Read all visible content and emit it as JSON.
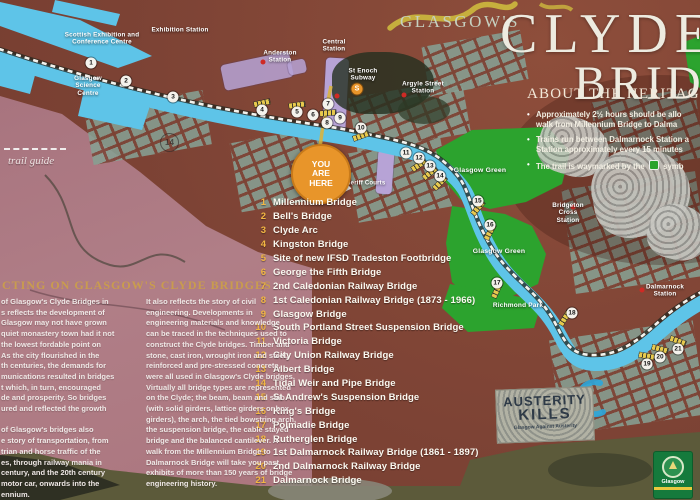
{
  "title": {
    "kicker": "GLASGOW'S",
    "line1": "CLYDE",
    "line2": "BRIDGES"
  },
  "heritage": {
    "heading": "ABOUT THE HERITAGE",
    "bullets": [
      {
        "lines": [
          "Approximately 2½ hours should be allo",
          "walk from Millennium Bridge to Dalma"
        ]
      },
      {
        "lines": [
          "Trains run between Dalmarnock Station a",
          "Station approximately every 15 minutes"
        ]
      },
      {
        "pre": "The trail is waymarked by the",
        "post": "symb"
      }
    ]
  },
  "bridge_list": [
    {
      "num": "1",
      "name": "Millennium Bridge"
    },
    {
      "num": "2",
      "name": "Bell's Bridge"
    },
    {
      "num": "3",
      "name": "Clyde Arc"
    },
    {
      "num": "4",
      "name": "Kingston Bridge"
    },
    {
      "num": "5",
      "name": "Site of new IFSD Tradeston Footbridge"
    },
    {
      "num": "6",
      "name": "George the Fifth Bridge"
    },
    {
      "num": "7",
      "name": "2nd Caledonian Railway Bridge"
    },
    {
      "num": "8",
      "name": "1st Caledonian Railway Bridge (1873 - 1966)"
    },
    {
      "num": "9",
      "name": "Glasgow Bridge"
    },
    {
      "num": "10",
      "name": "South Portland Street Suspension Bridge"
    },
    {
      "num": "11",
      "name": "Victoria Bridge"
    },
    {
      "num": "12",
      "name": "City Union Railway Bridge"
    },
    {
      "num": "13",
      "name": "Albert Bridge"
    },
    {
      "num": "14",
      "name": "Tidal Weir and Pipe Bridge"
    },
    {
      "num": "15",
      "name": "St Andrew's Suspension Bridge"
    },
    {
      "num": "16",
      "name": "King's Bridge"
    },
    {
      "num": "17",
      "name": "Polmadie Bridge"
    },
    {
      "num": "18",
      "name": "Rutherglen Bridge"
    },
    {
      "num": "19",
      "name": "1st Dalmarnock Railway Bridge (1861 - 1897)"
    },
    {
      "num": "20",
      "name": "2nd Dalmarnock Railway Bridge"
    },
    {
      "num": "21",
      "name": "Dalmarnock Bridge"
    }
  ],
  "map": {
    "you_are_here": "YOU\nARE\nHERE",
    "graffiti_number": "14",
    "subway_letter": "S",
    "labels": [
      {
        "text": "Scottish Exhibition and\nConference Centre",
        "x": 102,
        "y": 39
      },
      {
        "text": "Exhibition Station",
        "x": 180,
        "y": 30
      },
      {
        "text": "Glasgow\nScience\nCentre",
        "x": 88,
        "y": 86
      },
      {
        "text": "Anderston\nStation",
        "x": 280,
        "y": 57
      },
      {
        "text": "Central\nStation",
        "x": 334,
        "y": 46
      },
      {
        "text": "St Enoch\nSubway",
        "x": 363,
        "y": 75
      },
      {
        "text": "Argyle Street\nStation",
        "x": 423,
        "y": 88
      },
      {
        "text": "Glasgow Green",
        "x": 480,
        "y": 171,
        "fs": 6.8
      },
      {
        "text": "Glasgow Green",
        "x": 499,
        "y": 252,
        "fs": 6.8
      },
      {
        "text": "Bridgeton\nCross\nStation",
        "x": 568,
        "y": 213
      },
      {
        "text": "Richmond Park",
        "x": 518,
        "y": 306,
        "fs": 6.5
      },
      {
        "text": "Dalmarnock\nStation",
        "x": 665,
        "y": 291
      },
      {
        "text": "Sheriff Courts",
        "x": 364,
        "y": 184,
        "fs": 6
      }
    ],
    "markers": [
      {
        "n": "1",
        "x": 91,
        "y": 63
      },
      {
        "n": "2",
        "x": 126,
        "y": 81
      },
      {
        "n": "3",
        "x": 173,
        "y": 97
      },
      {
        "n": "4",
        "x": 262,
        "y": 110
      },
      {
        "n": "5",
        "x": 297,
        "y": 112
      },
      {
        "n": "6",
        "x": 313,
        "y": 115
      },
      {
        "n": "7",
        "x": 328,
        "y": 104
      },
      {
        "n": "8",
        "x": 327,
        "y": 123
      },
      {
        "n": "9",
        "x": 340,
        "y": 118
      },
      {
        "n": "10",
        "x": 361,
        "y": 128
      },
      {
        "n": "11",
        "x": 406,
        "y": 153
      },
      {
        "n": "12",
        "x": 419,
        "y": 158
      },
      {
        "n": "13",
        "x": 430,
        "y": 166
      },
      {
        "n": "14",
        "x": 440,
        "y": 176
      },
      {
        "n": "15",
        "x": 478,
        "y": 201
      },
      {
        "n": "16",
        "x": 490,
        "y": 225
      },
      {
        "n": "17",
        "x": 497,
        "y": 283
      },
      {
        "n": "18",
        "x": 572,
        "y": 313
      },
      {
        "n": "19",
        "x": 647,
        "y": 364
      },
      {
        "n": "20",
        "x": 660,
        "y": 357
      },
      {
        "n": "21",
        "x": 678,
        "y": 349
      }
    ],
    "bridge_bars": [
      {
        "x": 262,
        "y": 103,
        "r": 78
      },
      {
        "x": 297,
        "y": 105,
        "r": 82
      },
      {
        "x": 328,
        "y": 113,
        "r": 85
      },
      {
        "x": 361,
        "y": 136,
        "r": 70
      },
      {
        "x": 419,
        "y": 165,
        "r": 55
      },
      {
        "x": 430,
        "y": 173,
        "r": 50
      },
      {
        "x": 440,
        "y": 183,
        "r": 45
      },
      {
        "x": 478,
        "y": 208,
        "r": 40
      },
      {
        "x": 490,
        "y": 232,
        "r": 28
      },
      {
        "x": 497,
        "y": 290,
        "r": 24
      },
      {
        "x": 565,
        "y": 318,
        "r": 32
      },
      {
        "x": 647,
        "y": 356,
        "r": 100
      },
      {
        "x": 660,
        "y": 349,
        "r": 105
      },
      {
        "x": 678,
        "y": 341,
        "r": 110
      }
    ],
    "station_dots": [
      {
        "x": 263,
        "y": 62
      },
      {
        "x": 337,
        "y": 96
      },
      {
        "x": 404,
        "y": 95
      },
      {
        "x": 573,
        "y": 207
      },
      {
        "x": 642,
        "y": 290
      }
    ],
    "subway_pos": {
      "x": 357,
      "y": 89
    }
  },
  "reflecting": {
    "heading": "CTING ON GLASGOW'S CLYDE BRIDGES",
    "col1": [
      "of Glasgow's Clyde Bridges in",
      "s reflects the development of",
      "Glasgow may not have grown",
      "quiet monastery town had it not",
      "the lowest fordable point on",
      "As the city flourished in the",
      "th centuries, the demands for",
      "munications resulted in bridges",
      "t which, in turn, encouraged",
      "de and prosperity. So bridges",
      "ured and reflected the growth",
      "",
      "of Glasgow's bridges also",
      "e story of transportation, from",
      "trian and horse traffic of the",
      "es, through railway mania in",
      "century, and the 20th century",
      "motor car, onwards into the",
      "ennium."
    ],
    "col2": [
      "It also reflects the story of civil",
      "engineering. Developments in",
      "engineering materials and knowledge",
      "can be traced in the techniques used to",
      "construct the Clyde bridges. Timber and",
      "stone, cast iron, wrought iron and steel,",
      "reinforced and pre-stressed concrete,",
      "were all used in Glasgow's Clyde bridges.",
      "Virtually all bridge types are represented",
      "on the Clyde; the beam, beam and slab",
      "(with solid girders, lattice girders or box",
      "girders), the arch, the tied bowstring arch,",
      "the suspension bridge, the cable stayed",
      "bridge and the balanced cantilever. A",
      "walk from the Millennium Bridge to",
      "Dalmarnock Bridge will take you past",
      "exhibits of more than 150 years of bridge",
      "engineering history."
    ]
  },
  "trail_guide": "trail guide",
  "stickers": {
    "austerity": [
      "AUSTERITY",
      "KILLS",
      "Glasgow Against Austerity"
    ],
    "crest_label": "Glasgow"
  },
  "colors": {
    "river": "#5ec4e8",
    "park": "#2ca32e",
    "accent_gold": "#f3b743",
    "orange": "#e8952a",
    "brick": "#7d4335",
    "pink": "#ab7680"
  }
}
